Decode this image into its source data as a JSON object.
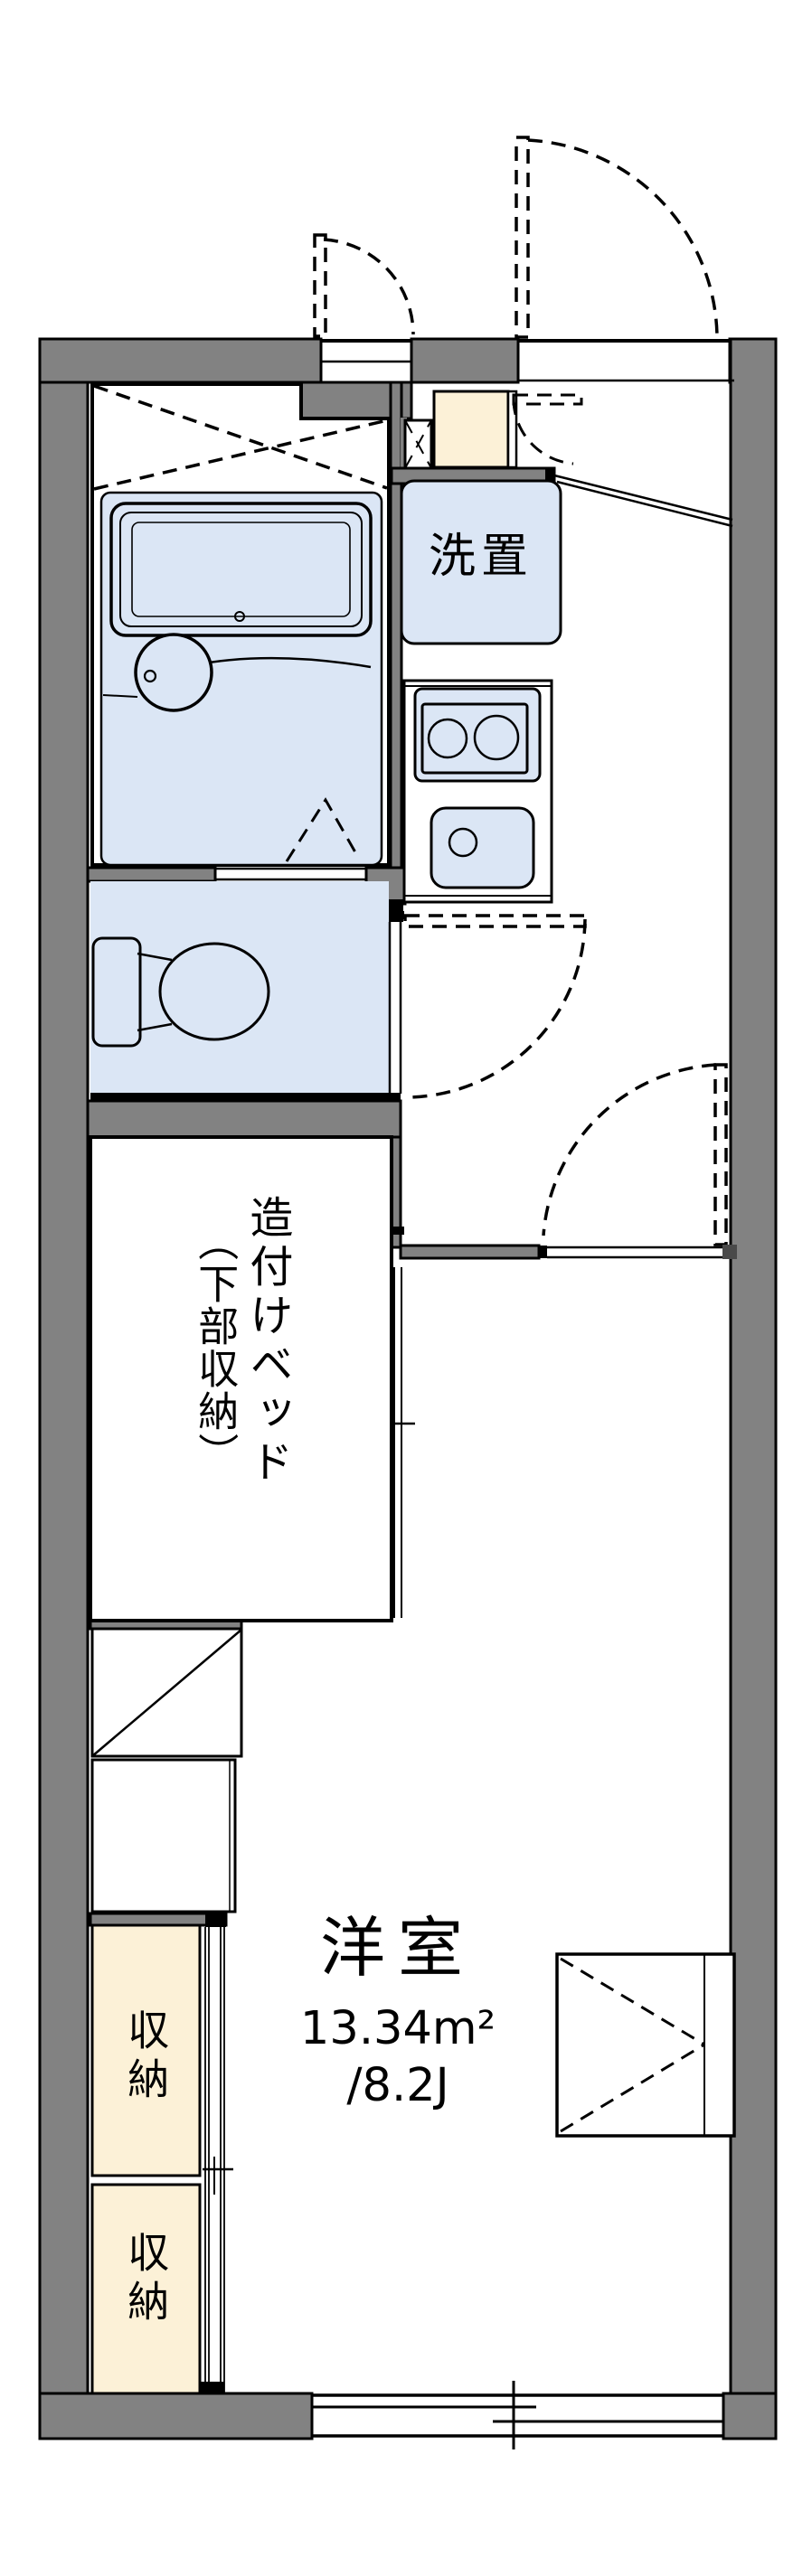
{
  "plan": {
    "type": "apartment-floor-plan",
    "labels": {
      "washer": "洗置",
      "bed_line1": "造付けベッド",
      "bed_line2": "（下部収納）",
      "storage_upper": "収納",
      "storage_lower": "収納",
      "room_name": "洋室",
      "room_area_m2": "13.34m²",
      "room_area_jo": "/8.2J"
    },
    "rooms": [
      {
        "name": "unit-bath",
        "fixtures": [
          "bathtub",
          "wash-basin"
        ]
      },
      {
        "name": "toilet-room",
        "fixtures": [
          "toilet"
        ]
      },
      {
        "name": "kitchen-corridor",
        "fixtures": [
          "washing-machine-space",
          "two-burner-stove",
          "sink",
          "shoe-cabinet",
          "pipe-space"
        ]
      },
      {
        "name": "western-room",
        "area_m2": "13.34",
        "area_tatami": "8.2J",
        "fixtures": [
          "built-in-bed-with-under-storage",
          "desk-counter",
          "storage-upper",
          "storage-lower",
          "wall-table",
          "sliding-window"
        ]
      }
    ]
  },
  "colors": {
    "wall": "#828282",
    "water": "#dbe6f5",
    "storage": "#fcf1d7",
    "background": "#ffffff",
    "line": "#000000"
  }
}
